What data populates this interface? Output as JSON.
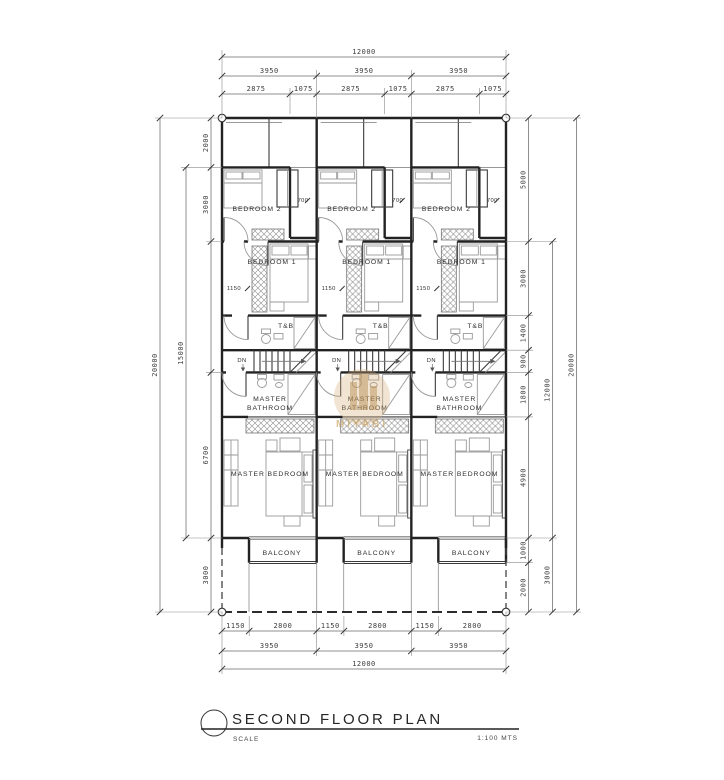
{
  "drawing": {
    "title": "SECOND FLOOR PLAN",
    "scale_label": "SCALE",
    "scale_value": "1:100 MTS"
  },
  "watermark": {
    "text": "MIYABI"
  },
  "room_labels": {
    "bedroom2": "BEDROOM 2",
    "bedroom1": "BEDROOM 1",
    "toilet_bath": "T&B",
    "master_bathroom_line1": "MASTER",
    "master_bathroom_line2": "BATHROOM",
    "master_bedroom": "MASTER BEDROOM",
    "balcony": "BALCONY",
    "stair_down": "DN"
  },
  "interior_dimensions": {
    "corridor_width": "700",
    "closet_width": "1150"
  },
  "dimensions": {
    "top": {
      "overall": "12000",
      "unit_widths": [
        "3950",
        "3950",
        "3950"
      ],
      "splits": [
        "2875",
        "1075",
        "2875",
        "1075",
        "2875",
        "1075"
      ]
    },
    "bottom": {
      "splits": [
        "1150",
        "2800",
        "1150",
        "2800",
        "1150",
        "2800"
      ],
      "unit_widths": [
        "3950",
        "3950",
        "3950"
      ],
      "overall": "12000"
    },
    "left": {
      "overall": "20000",
      "intermediate": "15000",
      "segments": [
        "2000",
        "3000",
        "6700",
        "3000"
      ]
    },
    "right": {
      "overall": "20000",
      "intermediate_main": "12000",
      "intermediate_lower": "3000",
      "segments": [
        "5000",
        "3000",
        "1400",
        "900",
        "1800",
        "4900",
        "1000",
        "2000"
      ]
    }
  }
}
